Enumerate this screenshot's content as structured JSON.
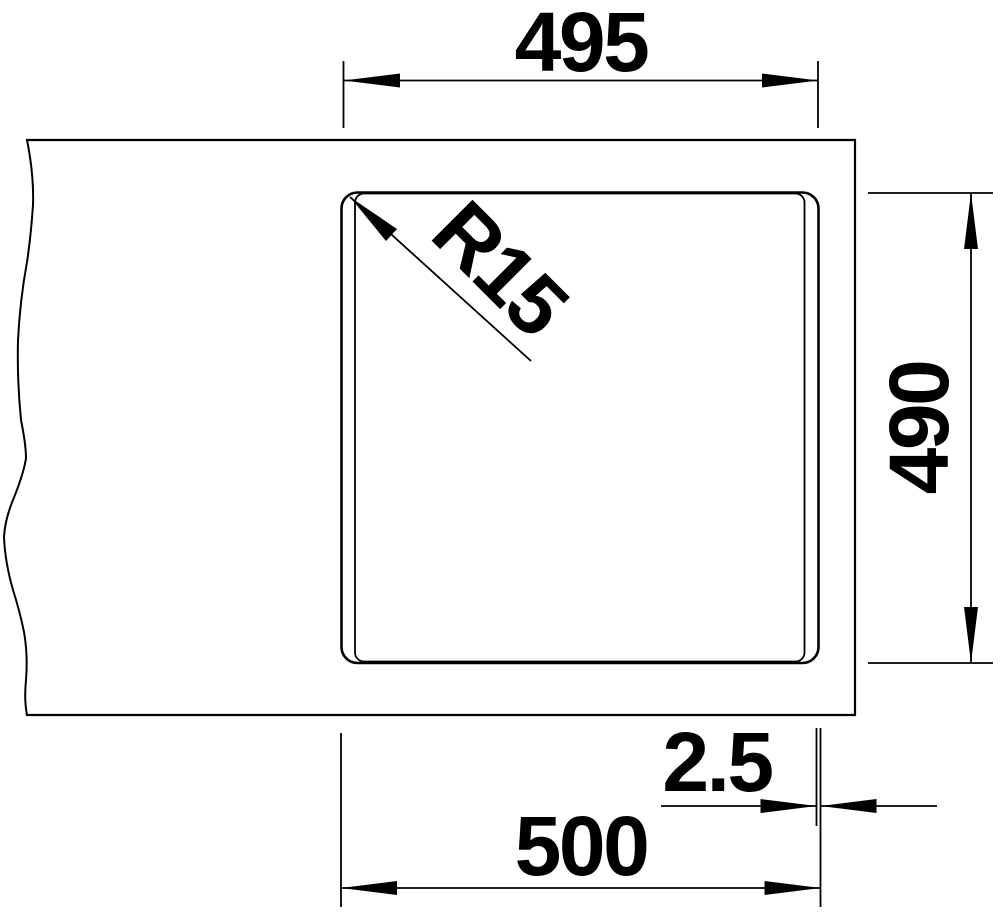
{
  "diagram": {
    "type": "technical-drawing",
    "subject": "sink-cutout-top-view",
    "background_color": "#ffffff",
    "line_color": "#000000",
    "dimension_labels": {
      "cutout_width": "495",
      "corner_radius": "R15",
      "cutout_depth": "490",
      "rim_offset": "2.5",
      "overall_width": "500"
    }
  }
}
